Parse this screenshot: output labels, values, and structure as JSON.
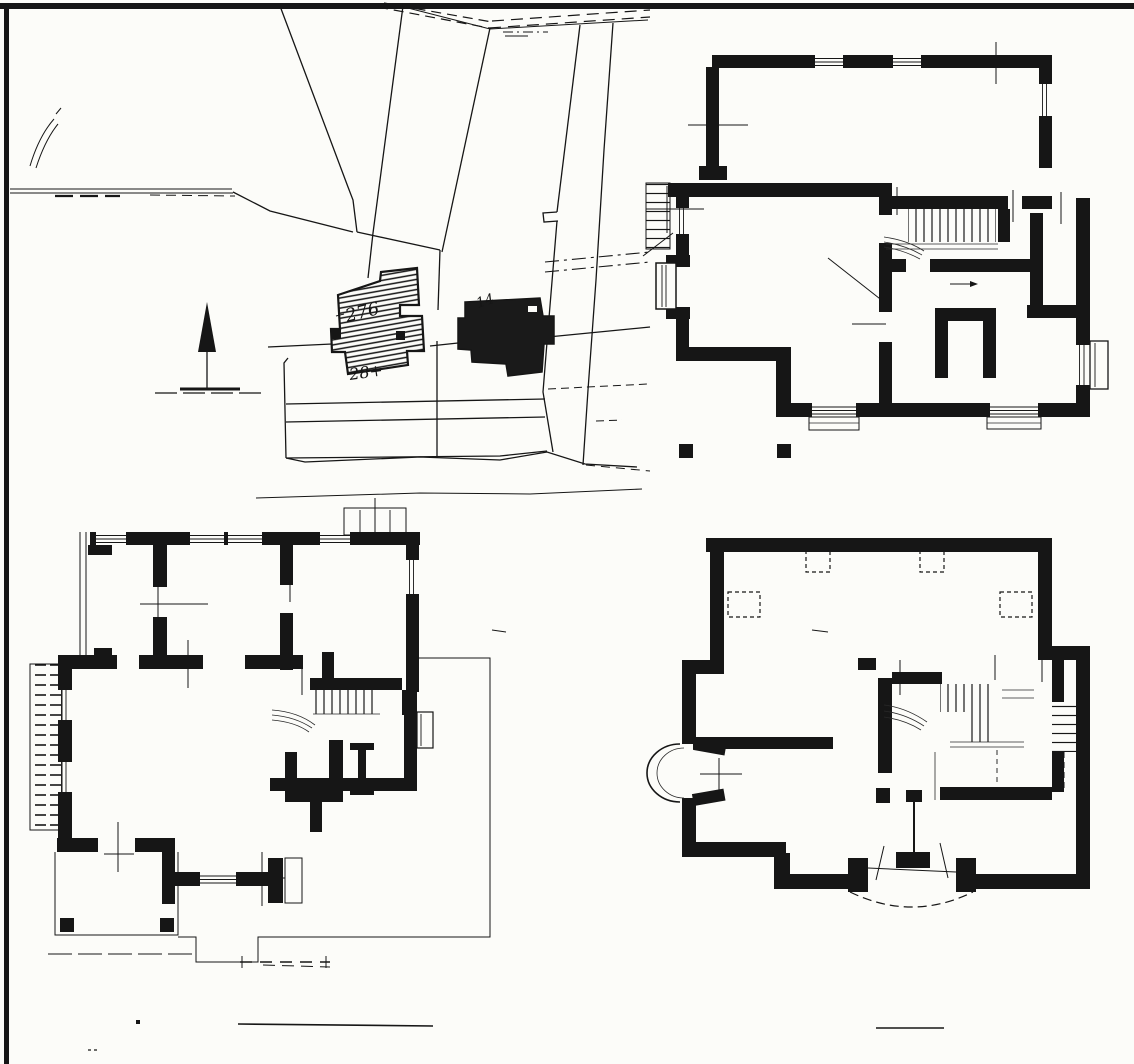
{
  "document": {
    "kind": "scanned architectural drawing",
    "paper_color": "#fcfcf9",
    "ink_color": "#161616"
  },
  "site_plan": {
    "labels": [
      {
        "text": "276"
      },
      {
        "text": "28+"
      },
      {
        "text": "14"
      }
    ]
  }
}
